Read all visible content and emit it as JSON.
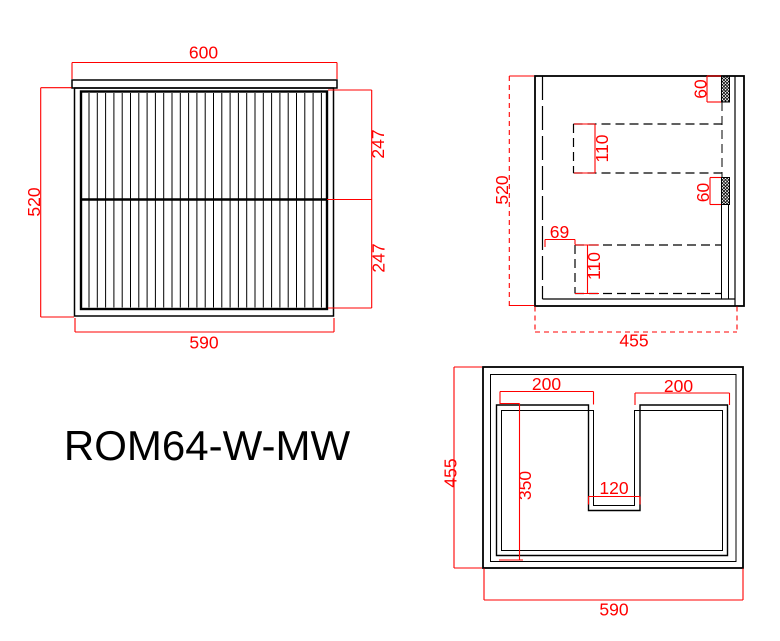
{
  "colors": {
    "outline": "#000000",
    "dimension": "#ff0000",
    "background": "#ffffff"
  },
  "title": "ROM64-W-MW",
  "front_view": {
    "dim_top_width": "600",
    "dim_height": "520",
    "dim_top_drawer_height": "247",
    "dim_bottom_drawer_height": "247",
    "dim_bottom_width": "590"
  },
  "side_view": {
    "dim_height": "520",
    "dim_top_rail": "60",
    "dim_top_drawer_depth": "110",
    "dim_mid_rail": "60",
    "dim_drawer_setback": "69",
    "dim_bottom_drawer_depth": "110",
    "dim_depth": "455"
  },
  "plan_view": {
    "dim_left_section": "200",
    "dim_right_section": "200",
    "dim_depth": "455",
    "dim_cutout_depth": "350",
    "dim_cutout_width": "120",
    "dim_width": "590"
  }
}
